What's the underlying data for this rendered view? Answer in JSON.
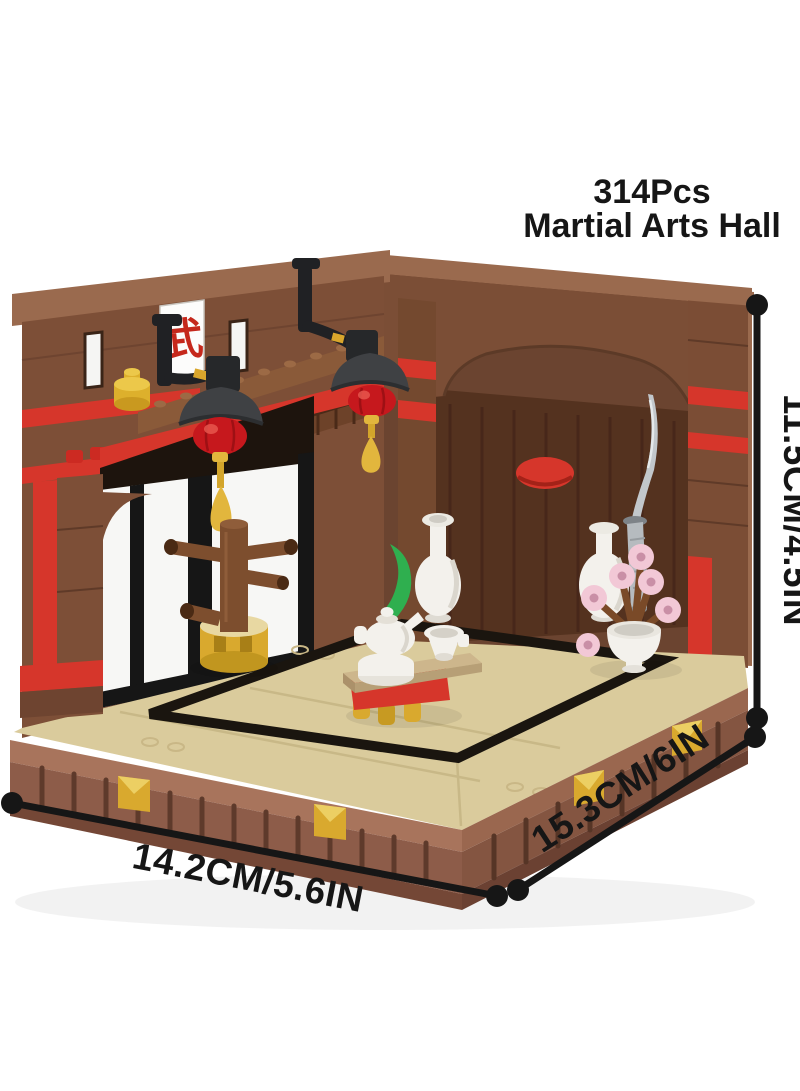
{
  "product": {
    "piece_count": "314Pcs",
    "title": "Martial Arts Hall"
  },
  "dimensions": {
    "height_label": "11.5CM/4.5IN",
    "width_label": "14.2CM/5.6IN",
    "depth_label": "15.3CM/6IN"
  },
  "decorations": {
    "sign_character": "武",
    "scroll_char_top": "龍",
    "scroll_char_bottom": "神"
  },
  "colors": {
    "bg": "#ffffff",
    "ink": "#161616",
    "wall_brown": "#7d4f37",
    "wall_cap": "#9a6a4e",
    "back_wall": "#6b4430",
    "door_brown": "#54321f",
    "accent_red": "#d6362b",
    "lantern_red": "#c6181d",
    "shade_gray": "#3f4144",
    "gold": "#e2b63d",
    "floor_tan": "#dacb9c",
    "platform_lip": "#a8745c",
    "platform_rib": "#8d5c49",
    "platform_base": "#744736",
    "ceramic_white": "#f3f1ec",
    "blossom_pink": "#f2c8d6",
    "plant_green": "#2faf4f",
    "blade_gray": "#c2c7cb"
  }
}
